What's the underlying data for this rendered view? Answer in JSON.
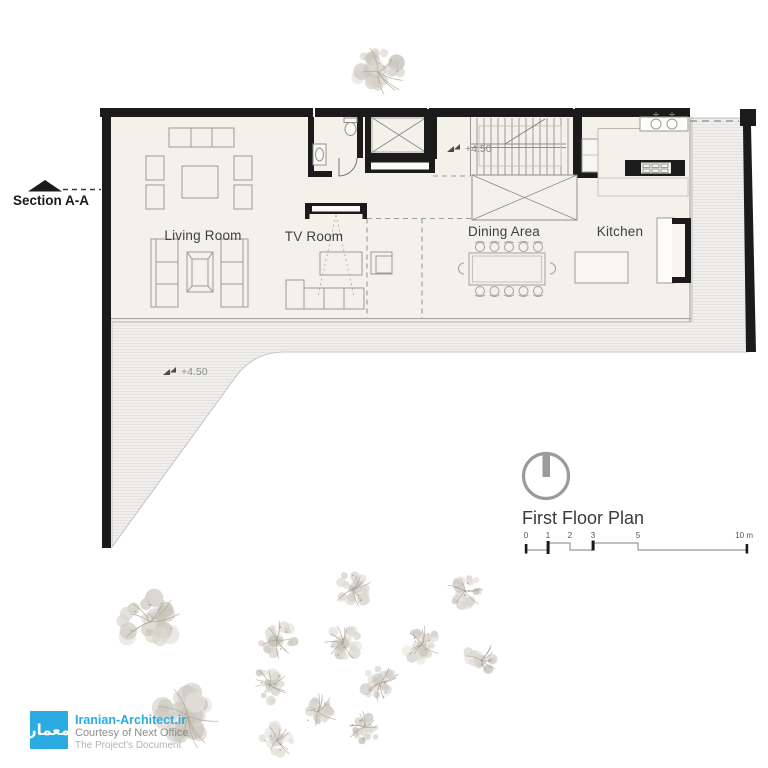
{
  "plan": {
    "section_label": "Section A-A",
    "rooms": {
      "living": "Living Room",
      "tv": "TV Room",
      "dining": "Dining Area",
      "kitchen": "Kitchen"
    },
    "levels": {
      "upper": "+4.50",
      "terrace": "+4.50"
    }
  },
  "titleblock": {
    "title": "First Floor Plan",
    "scale_ticks": [
      "0",
      "1",
      "2",
      "3",
      "5"
    ],
    "scale_end": "10 m"
  },
  "watermark": {
    "site": "Iranian-Architect.ir",
    "courtesy": "Courtesy of Next Office",
    "document": "The Project's Document",
    "logo_text": "معمار"
  },
  "colors": {
    "brand": "#2aabe2",
    "wall": "#1b1b1b",
    "floor": "#f3f1ea",
    "tree_palette": [
      "#dad6cf",
      "#cfcbc3",
      "#e2dfd8",
      "#c8c4bb"
    ],
    "tree_branch": "#ab9f94"
  },
  "site": {
    "trees": [
      {
        "x": 378,
        "y": 72,
        "r": 29
      },
      {
        "x": 150,
        "y": 622,
        "r": 34
      },
      {
        "x": 188,
        "y": 716,
        "r": 36
      },
      {
        "x": 353,
        "y": 589,
        "r": 21
      },
      {
        "x": 465,
        "y": 591,
        "r": 20
      },
      {
        "x": 277,
        "y": 640,
        "r": 21
      },
      {
        "x": 343,
        "y": 643,
        "r": 21
      },
      {
        "x": 422,
        "y": 645,
        "r": 21
      },
      {
        "x": 481,
        "y": 660,
        "r": 19
      },
      {
        "x": 270,
        "y": 685,
        "r": 21
      },
      {
        "x": 380,
        "y": 683,
        "r": 21
      },
      {
        "x": 318,
        "y": 712,
        "r": 20
      },
      {
        "x": 365,
        "y": 727,
        "r": 19
      },
      {
        "x": 277,
        "y": 740,
        "r": 19
      }
    ]
  }
}
